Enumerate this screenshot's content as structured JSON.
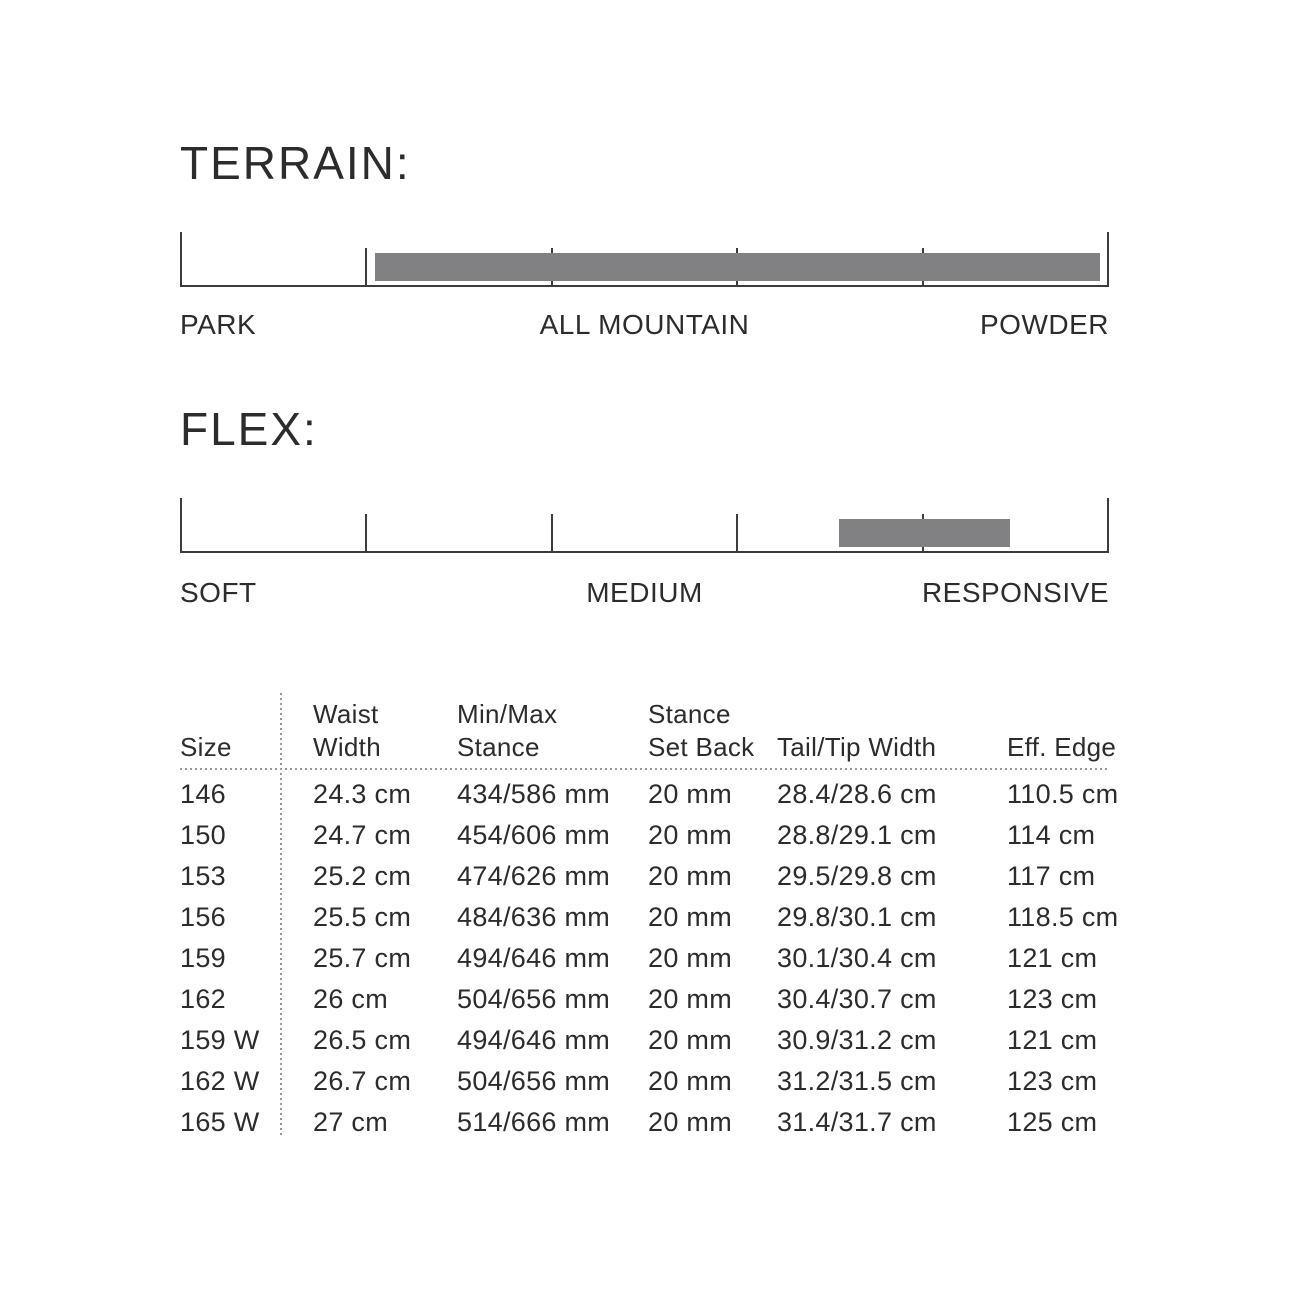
{
  "chart_data": [
    {
      "type": "bar",
      "id": "terrain-scale",
      "title": "TERRAIN:",
      "orientation": "horizontal",
      "axis_labels": [
        "PARK",
        "ALL MOUNTAIN",
        "POWDER"
      ],
      "tick_count": 6,
      "range_pct": [
        0,
        100
      ],
      "bar_start_pct": 21.0,
      "bar_end_pct": 99.0,
      "bar_color": "#818184",
      "line_color": "#3c3c3e"
    },
    {
      "type": "bar",
      "id": "flex-scale",
      "title": "FLEX:",
      "orientation": "horizontal",
      "axis_labels": [
        "SOFT",
        "MEDIUM",
        "RESPONSIVE"
      ],
      "tick_count": 6,
      "range_pct": [
        0,
        100
      ],
      "bar_start_pct": 70.9,
      "bar_end_pct": 89.3,
      "bar_color": "#818184",
      "line_color": "#3c3c3e"
    },
    {
      "type": "table",
      "id": "size-spec-table",
      "columns": [
        "Size",
        "Waist Width",
        "Min/Max Stance",
        "Stance Set Back",
        "Tail/Tip Width",
        "Eff. Edge"
      ],
      "header_lines": [
        [
          "Size"
        ],
        [
          "Waist",
          "Width"
        ],
        [
          "Min/Max",
          "Stance"
        ],
        [
          "Stance",
          "Set Back"
        ],
        [
          "Tail/Tip Width"
        ],
        [
          "Eff. Edge"
        ]
      ],
      "rows": [
        [
          "146",
          "24.3 cm",
          "434/586 mm",
          "20 mm",
          "28.4/28.6 cm",
          "110.5 cm"
        ],
        [
          "150",
          "24.7 cm",
          "454/606 mm",
          "20 mm",
          "28.8/29.1 cm",
          "114 cm"
        ],
        [
          "153",
          "25.2 cm",
          "474/626 mm",
          "20 mm",
          "29.5/29.8 cm",
          "117 cm"
        ],
        [
          "156",
          "25.5 cm",
          "484/636 mm",
          "20 mm",
          "29.8/30.1 cm",
          "118.5 cm"
        ],
        [
          "159",
          "25.7 cm",
          "494/646 mm",
          "20 mm",
          "30.1/30.4 cm",
          "121 cm"
        ],
        [
          "162",
          "26 cm",
          "504/656 mm",
          "20 mm",
          "30.4/30.7 cm",
          "123 cm"
        ],
        [
          "159 W",
          "26.5 cm",
          "494/646 mm",
          "20 mm",
          "30.9/31.2 cm",
          "121 cm"
        ],
        [
          "162 W",
          "26.7 cm",
          "504/656 mm",
          "20 mm",
          "31.2/31.5 cm",
          "123 cm"
        ],
        [
          "165 W",
          "27 cm",
          "514/666 mm",
          "20 mm",
          "31.4/31.7 cm",
          "125 cm"
        ]
      ]
    }
  ]
}
